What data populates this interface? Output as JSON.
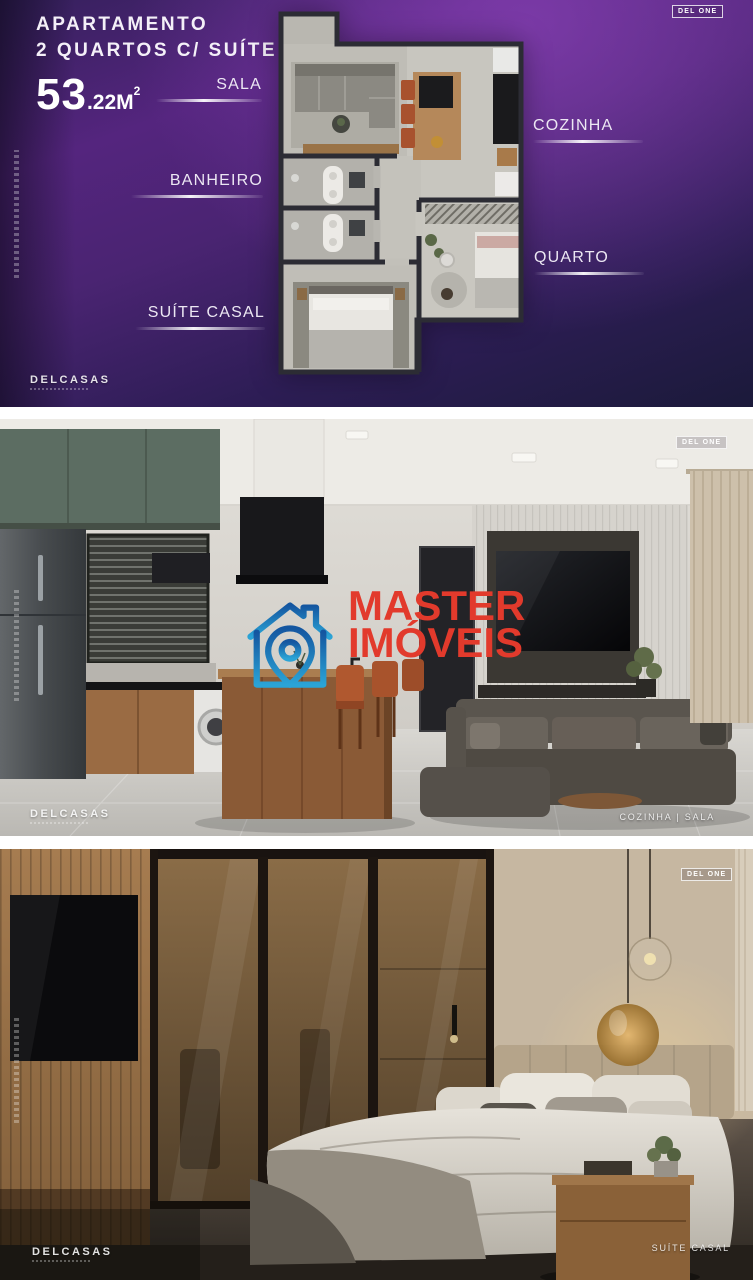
{
  "floorplan": {
    "badge": "DEL ONE",
    "title_line1": "APARTAMENTO",
    "title_line2": "2 QUARTOS C/ SUÍTE",
    "area_big": "53",
    "area_small": ".22",
    "area_unit": "M",
    "area_sup": "2",
    "labels": {
      "sala": "SALA",
      "cozinha": "COZINHA",
      "banheiro": "BANHEIRO",
      "quarto": "QUARTO",
      "suite_casal": "SUÍTE CASAL"
    },
    "brand": "DELCASAS"
  },
  "kitchen": {
    "badge": "DEL ONE",
    "brand": "DELCASAS",
    "caption": "COZINHA | SALA"
  },
  "bedroom": {
    "badge": "DEL ONE",
    "brand": "DELCASAS",
    "caption": "SUÍTE CASAL"
  },
  "watermark": {
    "line1": "MASTER",
    "line2": "IMÓVEIS"
  },
  "colors": {
    "watermark_red": "#e23a2c",
    "logo_blue_top": "#1456a0",
    "logo_blue_bottom": "#2ba4d6",
    "purple": "#5c2d86",
    "navy": "#1d1a3e"
  }
}
